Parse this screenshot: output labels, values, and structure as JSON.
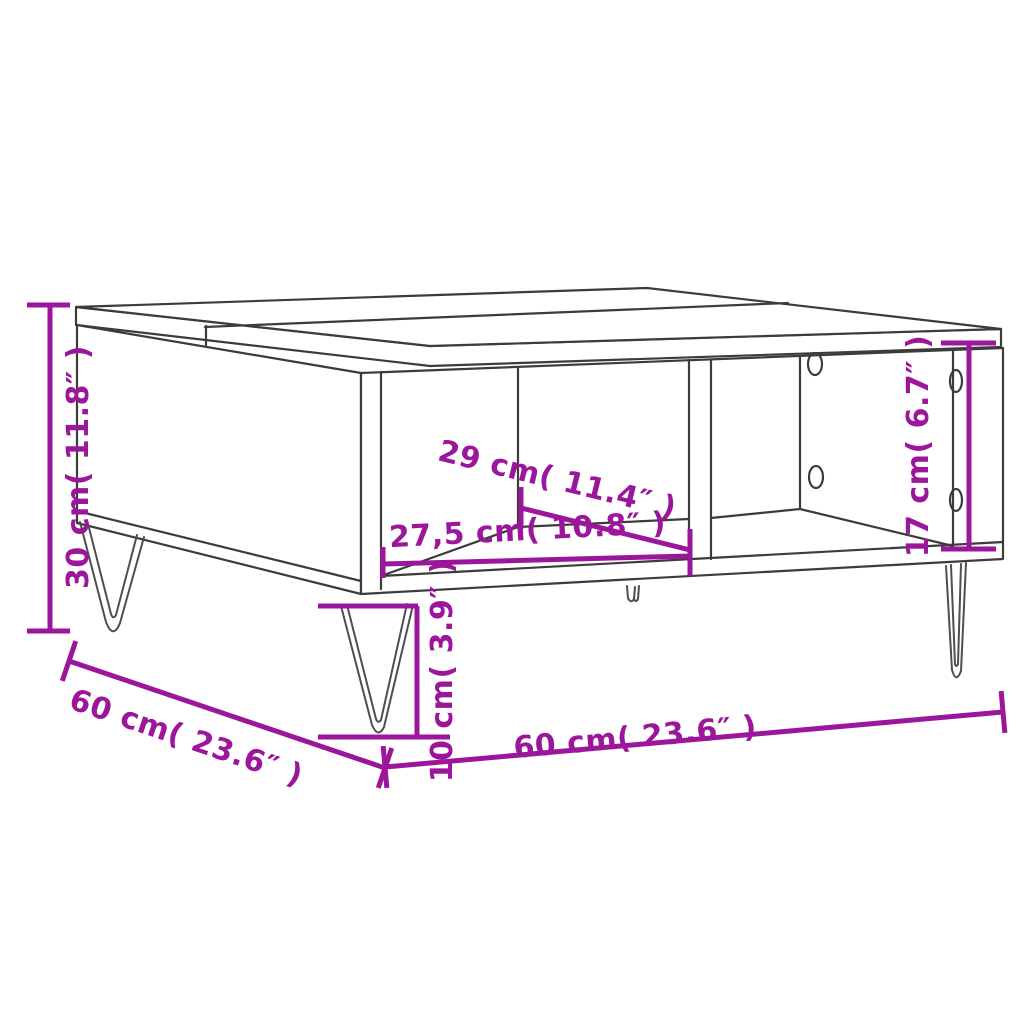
{
  "diagram": {
    "kind": "furniture-dimension-diagram",
    "subject": "coffee table with hairpin legs and open storage compartments",
    "accent_color": "#9B169B",
    "line_color": "#3C3C3C",
    "background_color": "#FFFFFF",
    "dimensions": {
      "height": {
        "label": "30 cm( 11.8″ )",
        "cm": 30,
        "inches": 11.8
      },
      "depth": {
        "label": "60 cm( 23.6″ )",
        "cm": 60,
        "inches": 23.6
      },
      "width": {
        "label": "60 cm( 23.6″ )",
        "cm": 60,
        "inches": 23.6
      },
      "compartment_depth": {
        "label": "29 cm( 11.4″ )",
        "cm": 29,
        "inches": 11.4
      },
      "compartment_width": {
        "label": "27,5 cm( 10.8″ )",
        "cm": 27.5,
        "inches": 10.8
      },
      "compartment_height": {
        "label": "17 cm( 6.7″ )",
        "cm": 17,
        "inches": 6.7
      },
      "leg_height": {
        "label": "10 cm( 3.9″ )",
        "cm": 10,
        "inches": 3.9
      }
    }
  }
}
